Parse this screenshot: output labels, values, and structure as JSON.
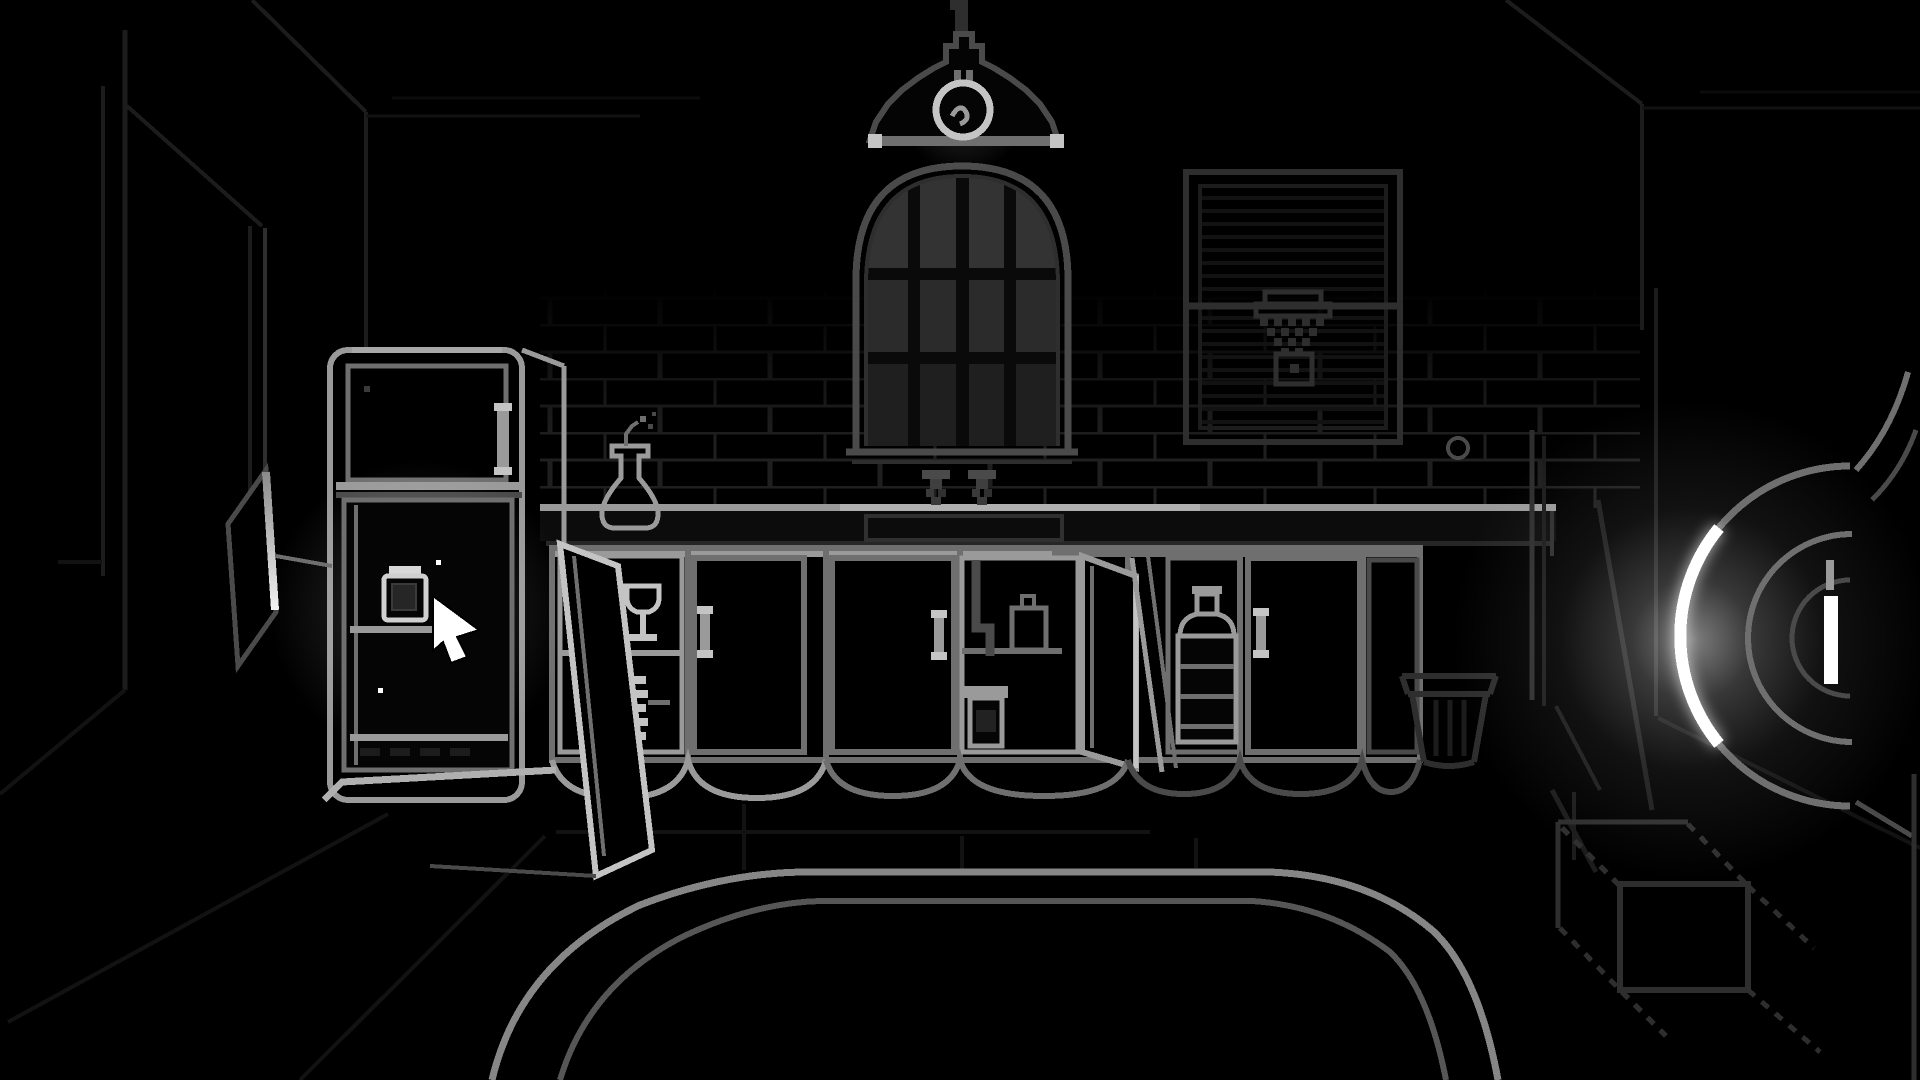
{
  "scene": {
    "title": "Monochrome pixel-art kitchen scene",
    "style": "1-bit line art on black",
    "objects": [
      {
        "name": "pendant-lamp",
        "label": "hanging dome lamp with filament bulb"
      },
      {
        "name": "arched-window",
        "label": "arched window with 12 dark panes"
      },
      {
        "name": "blinds-window",
        "label": "window covered by closed blinds"
      },
      {
        "name": "hanging-net",
        "label": "net bag hanging on blinds"
      },
      {
        "name": "refrigerator",
        "label": "refrigerator with open glowing lower door"
      },
      {
        "name": "jar",
        "label": "jar on fridge shelf under cursor"
      },
      {
        "name": "wine-glasses",
        "label": "wine glasses on open shelf"
      },
      {
        "name": "plate-stack",
        "label": "stack of plates on open shelf"
      },
      {
        "name": "under-sink-cabinet",
        "label": "open cabinet with drain pipe, canister and crock"
      },
      {
        "name": "water-jug",
        "label": "large ribbed water jug in open cabinet"
      },
      {
        "name": "vase",
        "label": "vase with wilted sprig on counter"
      },
      {
        "name": "faucet-knobs",
        "label": "two tap handles above sink"
      },
      {
        "name": "trash-bin",
        "label": "ribbed waste bin"
      },
      {
        "name": "mop",
        "label": "mop poles leaning at wall"
      },
      {
        "name": "spotlight",
        "label": "large glowing lamp head at right edge"
      },
      {
        "name": "box",
        "label": "dashed wireframe box on floor"
      },
      {
        "name": "rug",
        "label": "double-line rug outline on tiled floor"
      }
    ],
    "cursor": {
      "shape": "arrow",
      "x": 433,
      "y": 596
    }
  },
  "palette": {
    "bg": "#000000",
    "line_faint": "#121212",
    "line_dim": "#1c1c1c",
    "line_low": "#2e2e2e",
    "line_mid": "#4a4a4a",
    "line_soft": "#6f6f6f",
    "line_bright": "#9a9a9a",
    "line_brighter": "#c4c4c4",
    "white": "#ffffff",
    "pane": "#2b2b2b",
    "mortar": "#1f1f1f"
  }
}
